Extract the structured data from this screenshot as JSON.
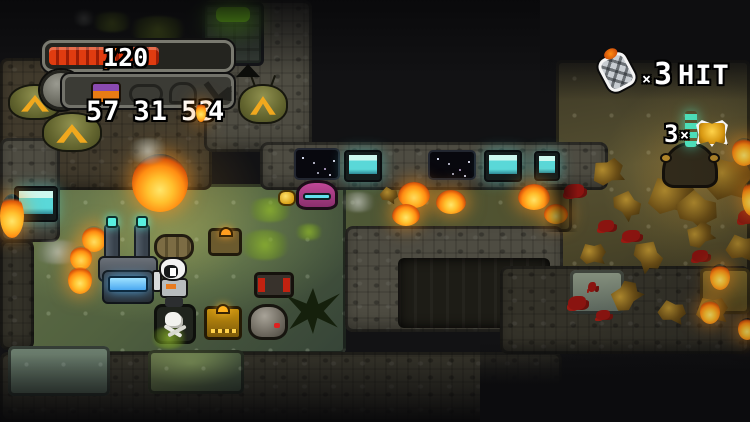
{
  "hud": {
    "health": {
      "current": "17",
      "separator": "/",
      "max": "20",
      "fill_percent": 58,
      "bar_color": "#e03c10"
    },
    "ammo": {
      "counts": [
        "57",
        "31",
        "53"
      ],
      "special": "4"
    },
    "grenade": {
      "times": "×",
      "count": "3",
      "label": "HIT"
    },
    "loot": {
      "count": "3",
      "times": "×"
    }
  },
  "colors": {
    "health_red": "#e03c10",
    "screen_cyan": "#5ad8d8",
    "door_green": "#86f01e",
    "fire_orange": "#ff9a1a",
    "gold": "#e8b83a",
    "floor_green": "#51613f",
    "enemy_purple": "#b0418c",
    "console_blue": "#59c7ff"
  }
}
